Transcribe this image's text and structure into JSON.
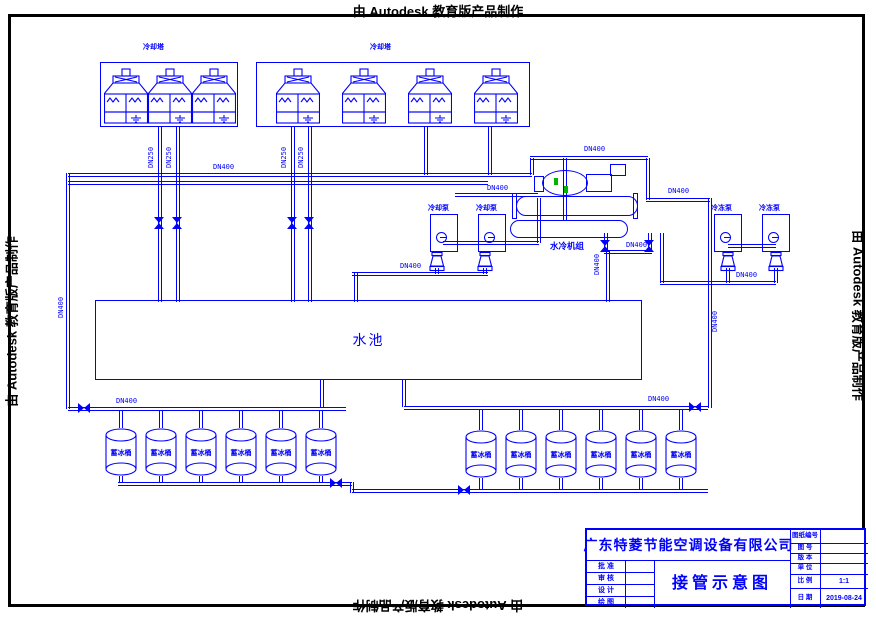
{
  "watermarks": {
    "top": "由 Autodesk 教育版产品制作",
    "bottom": "由 Autodesk 教育版产品制作",
    "left": "由 Autodesk 教育版产品制作",
    "right": "由 Autodesk 教育版产品制作"
  },
  "colors": {
    "line": "#0000ff",
    "frame": "#000000",
    "highlight": "#00b400"
  },
  "diagram": {
    "pool_label": "水池",
    "chiller_label": "水冷机组",
    "tank_label": "蓄冰桶",
    "tower_groups": [
      {
        "label": "冷却塔",
        "count": 3
      },
      {
        "label": "冷却塔",
        "count": 4
      }
    ],
    "tank_groups": [
      {
        "count": 6
      },
      {
        "count": 6
      }
    ],
    "pump_groups": [
      {
        "side": "left",
        "labels": [
          "冷却泵",
          "冷却泵"
        ]
      },
      {
        "side": "right",
        "labels": [
          "冷冻泵",
          "冷冻泵"
        ]
      }
    ],
    "pipe_labels": [
      {
        "text": "DN250",
        "x": 148,
        "y": 168,
        "vert": true
      },
      {
        "text": "DN250",
        "x": 166,
        "y": 168,
        "vert": true
      },
      {
        "text": "DN250",
        "x": 281,
        "y": 168,
        "vert": true
      },
      {
        "text": "DN250",
        "x": 298,
        "y": 168,
        "vert": true
      },
      {
        "text": "DN400",
        "x": 213,
        "y": 164,
        "vert": false
      },
      {
        "text": "DN400",
        "x": 584,
        "y": 146,
        "vert": false
      },
      {
        "text": "DN400",
        "x": 668,
        "y": 188,
        "vert": false
      },
      {
        "text": "DN400",
        "x": 487,
        "y": 185,
        "vert": false
      },
      {
        "text": "DN400",
        "x": 400,
        "y": 263,
        "vert": false
      },
      {
        "text": "DN400",
        "x": 626,
        "y": 242,
        "vert": false
      },
      {
        "text": "DN400",
        "x": 736,
        "y": 272,
        "vert": false
      },
      {
        "text": "DN400",
        "x": 116,
        "y": 398,
        "vert": false
      },
      {
        "text": "DN400",
        "x": 648,
        "y": 396,
        "vert": false
      },
      {
        "text": "DN400",
        "x": 58,
        "y": 318,
        "vert": true
      },
      {
        "text": "DN400",
        "x": 712,
        "y": 332,
        "vert": true
      },
      {
        "text": "DN400",
        "x": 594,
        "y": 275,
        "vert": true
      }
    ]
  },
  "titleblock": {
    "company": "广东特菱节能空调设备有限公司",
    "drawing_title": "接管示意图",
    "left_rows": [
      {
        "label": "批 准",
        "value": ""
      },
      {
        "label": "审 核",
        "value": ""
      },
      {
        "label": "设 计",
        "value": ""
      },
      {
        "label": "绘 图",
        "value": ""
      }
    ],
    "right_rows": [
      {
        "label": "图纸编号",
        "value": ""
      },
      {
        "label": "图 号",
        "value": ""
      },
      {
        "label": "版 本",
        "value": ""
      },
      {
        "label": "单 位",
        "value": ""
      },
      {
        "label": "比 例",
        "value": "1:1"
      },
      {
        "label": "日 期",
        "value": "2019-08-24"
      }
    ]
  }
}
